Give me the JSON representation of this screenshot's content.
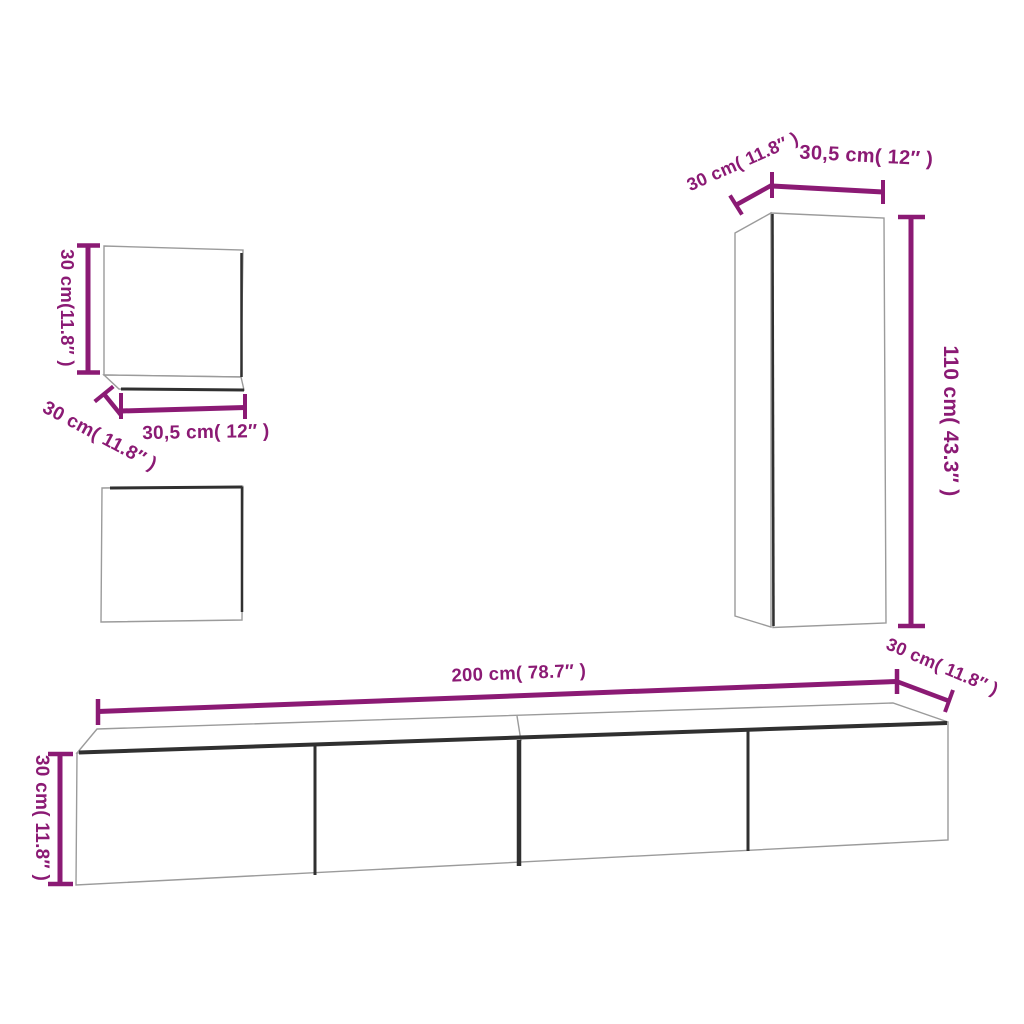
{
  "colors": {
    "accent": "#8B1A74",
    "outline": "#9b9b9b",
    "edge_dark": "#303030",
    "background": "#ffffff"
  },
  "pieces": [
    {
      "id": "wall-cabinet-small-top",
      "labels": {
        "height": "30 cm(11.8″ )",
        "width": "30,5 cm( 12″ )",
        "depth": "30 cm( 11.8″ )"
      }
    },
    {
      "id": "wall-cabinet-small-bottom",
      "labels": {}
    },
    {
      "id": "wall-cabinet-tall",
      "labels": {
        "depth": "30 cm( 11.8″ )",
        "width": "30,5 cm( 12″ )",
        "height": "110 cm( 43.3″ )"
      }
    },
    {
      "id": "tv-stand",
      "labels": {
        "width": "200 cm( 78.7″ )",
        "depth": "30 cm( 11.8″ )",
        "height": "30 cm( 11.8″ )"
      }
    }
  ]
}
